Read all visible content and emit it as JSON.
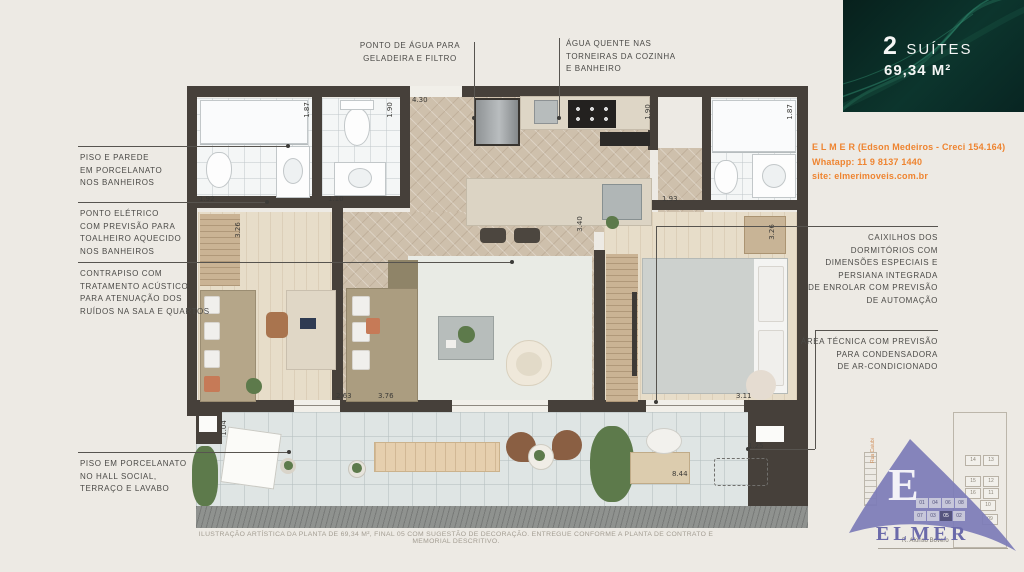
{
  "badge": {
    "count": "2",
    "label": "SUÍTES",
    "area": "69,34 M²"
  },
  "contact": {
    "line1": "E L M E R (Edson Medeiros - Creci 154.164)",
    "line2": "Whatapp: 11 9 8137 1440",
    "line3": "site: elmerimoveis.com.br",
    "accent_color": "#ee8430"
  },
  "callouts": {
    "left": [
      {
        "text": "PISO E PAREDE\nEM PORCELANATO\nNOS BANHEIROS"
      },
      {
        "text": "PONTO ELÉTRICO\nCOM PREVISÃO PARA\nTOALHEIRO AQUECIDO\nNOS BANHEIROS"
      },
      {
        "text": "CONTRAPISO COM\nTRATAMENTO ACÚSTICO\nPARA ATENUAÇÃO DOS\nRUÍDOS NA SALA E QUARTOS"
      },
      {
        "text": "PISO EM PORCELANATO\nNO HALL SOCIAL,\nTERRAÇO E LAVABO"
      }
    ],
    "top": [
      {
        "text": "PONTO DE ÁGUA PARA\nGELADEIRA E FILTRO"
      },
      {
        "text": "ÁGUA QUENTE NAS\nTORNEIRAS DA COZINHA\nE BANHEIRO"
      }
    ],
    "right": [
      {
        "text": "CAIXILHOS DOS\nDORMITÓRIOS COM\nDIMENSÕES ESPECIAIS E\nPERSIANA INTEGRADA\nDE ENROLAR COM PREVISÃO\nDE AUTOMAÇÃO"
      },
      {
        "text": "ÁREA TÉCNICA COM PREVISÃO\nPARA CONDENSADORA\nDE AR-CONDICIONADO"
      }
    ]
  },
  "plan": {
    "dimensions": [
      "4.30",
      "1.87",
      "1.90",
      "1.90",
      "1.87",
      "1.92",
      "1.10",
      "1.93",
      "3.26",
      "3.40",
      "3.26",
      "2.63",
      "3.76",
      "3.11",
      "1.04",
      "8.44",
      "1.25"
    ],
    "wall_color": "#46403a"
  },
  "disclaimer": "ILUSTRAÇÃO ARTÍSTICA DA PLANTA DE 69,34 M², FINAL 05 COM SUGESTÃO DE DECORAÇÃO. ENTREGUE CONFORME A PLANTA DE CONTRATO E MEMORIAL DESCRITIVO.",
  "logo": {
    "initial": "E",
    "brand": "ELMER",
    "brand_color": "#6b6aaa",
    "street_bottom": "R. Afonso Bovero",
    "street_side": "Rua Caiubi",
    "sitemap": {
      "pairs": [
        [
          "14",
          "13"
        ],
        [
          "15",
          "12"
        ],
        [
          "16",
          "11"
        ]
      ],
      "singles": [
        "10",
        "09"
      ],
      "row_top": [
        "01",
        "04",
        "06",
        "08"
      ],
      "row_bottom": [
        "07",
        "03",
        "05",
        "02"
      ],
      "highlight": "05"
    }
  }
}
